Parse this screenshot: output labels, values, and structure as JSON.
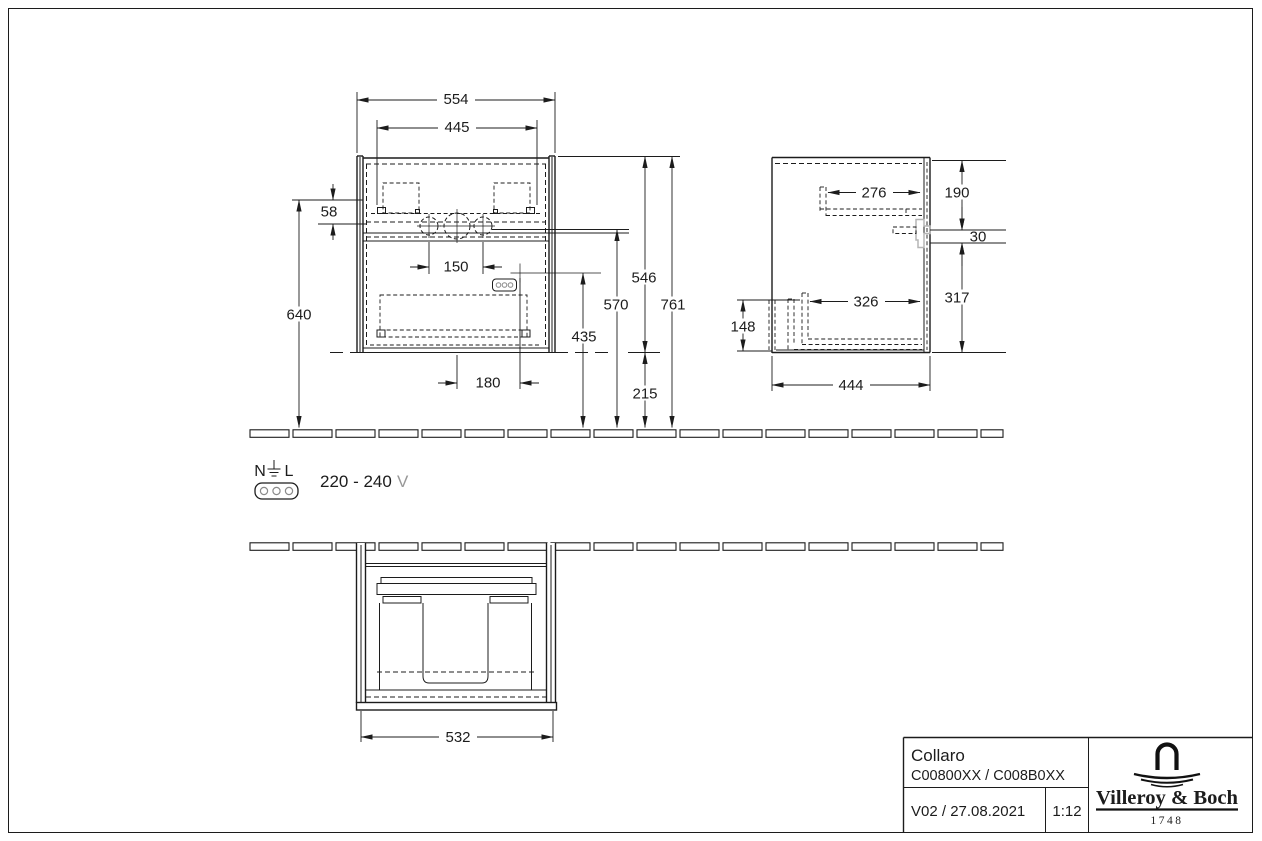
{
  "drawing": {
    "front_view": {
      "dims": {
        "width_outer": "554",
        "width_inner": "445",
        "top_offset": "58",
        "tap_spacing": "150",
        "height_left": "640",
        "siphon_height": "435",
        "rail_height": "570",
        "cabinet_height": "546",
        "gap_below": "215",
        "total_height": "761",
        "siphon_offset": "180"
      }
    },
    "side_view": {
      "dims": {
        "upper_rail_depth": "276",
        "upper_height": "190",
        "bracket_height": "30",
        "lower_rail_depth": "326",
        "lower_height": "317",
        "front_height": "148",
        "depth": "444"
      }
    },
    "plan_view": {
      "dims": {
        "front_width": "532"
      }
    },
    "electrical": {
      "neutral": "N",
      "line": "L",
      "voltage_range": "220 - 240",
      "voltage_unit": "V"
    },
    "title_block": {
      "product_name": "Collaro",
      "article_numbers": "C00800XX / C008B0XX",
      "version_date": "V02 / 27.08.2021",
      "drawing_scale": "1:12",
      "brand_name": "Villeroy & Boch",
      "brand_founded": "1748"
    }
  },
  "colors": {
    "line": "#1c1c1c",
    "gray_part": "#b5b5b5",
    "muted_text": "#989898"
  }
}
